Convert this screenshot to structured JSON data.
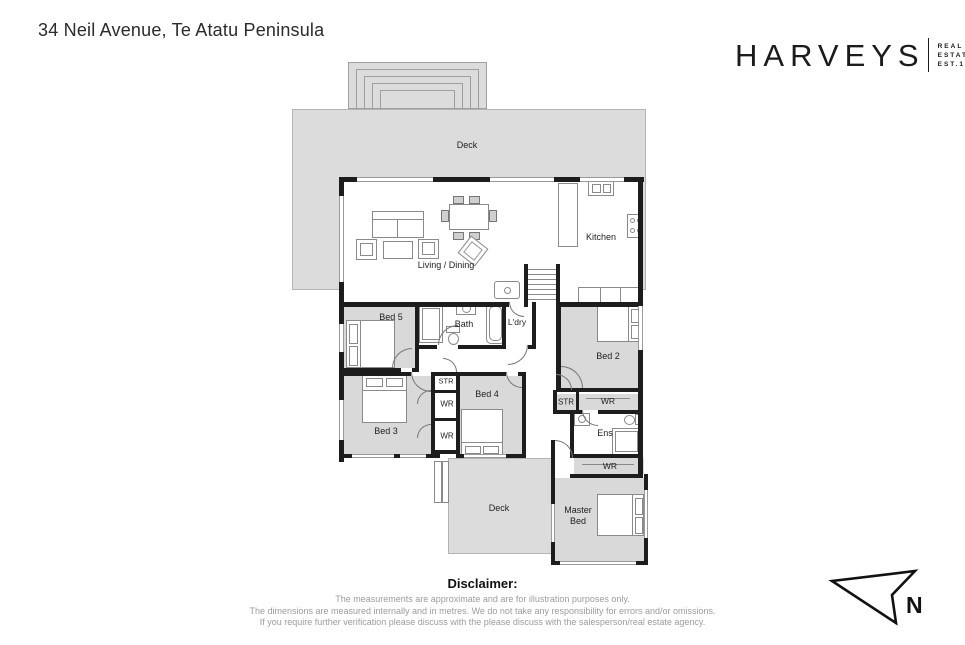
{
  "page_title": "34 Neil Avenue, Te Atatu Peninsula",
  "brand": {
    "name": "HARVEYS",
    "sub": [
      "REAL",
      "ESTATE",
      "EST.1918"
    ]
  },
  "floorplan": {
    "labels": {
      "deck_top": "Deck",
      "living_dining": "Living / Dining",
      "kitchen": "Kitchen",
      "bed5": "Bed 5",
      "bath": "Bath",
      "laundry": "L'dry",
      "bed2": "Bed 2",
      "bed3": "Bed 3",
      "bed4": "Bed 4",
      "str_left": "STR",
      "wr_left_top": "WR",
      "wr_left_bottom": "WR",
      "str_right": "STR",
      "wr_right_top": "WR",
      "ensuite": "Ens",
      "wr_right_bottom": "WR",
      "deck_bottom": "Deck",
      "master_bed": "Master Bed"
    },
    "compass": "N"
  },
  "disclaimer": {
    "heading": "Disclaimer:",
    "lines": [
      "The measurements are approximate and are for illustration purposes only.",
      "The dimensions are measured internally and in metres. We do not take any responsibility for errors and/or omissions.",
      "If you require further verification please discuss with the please discuss with the salesperson/real estate agency."
    ]
  },
  "colors": {
    "wall": "#1d1d1d",
    "deck_fill": "#dcdcdc",
    "room_fill": "#d9d9d9",
    "title_text": "#2b2b2b",
    "muted_text": "#9c9c9c"
  }
}
